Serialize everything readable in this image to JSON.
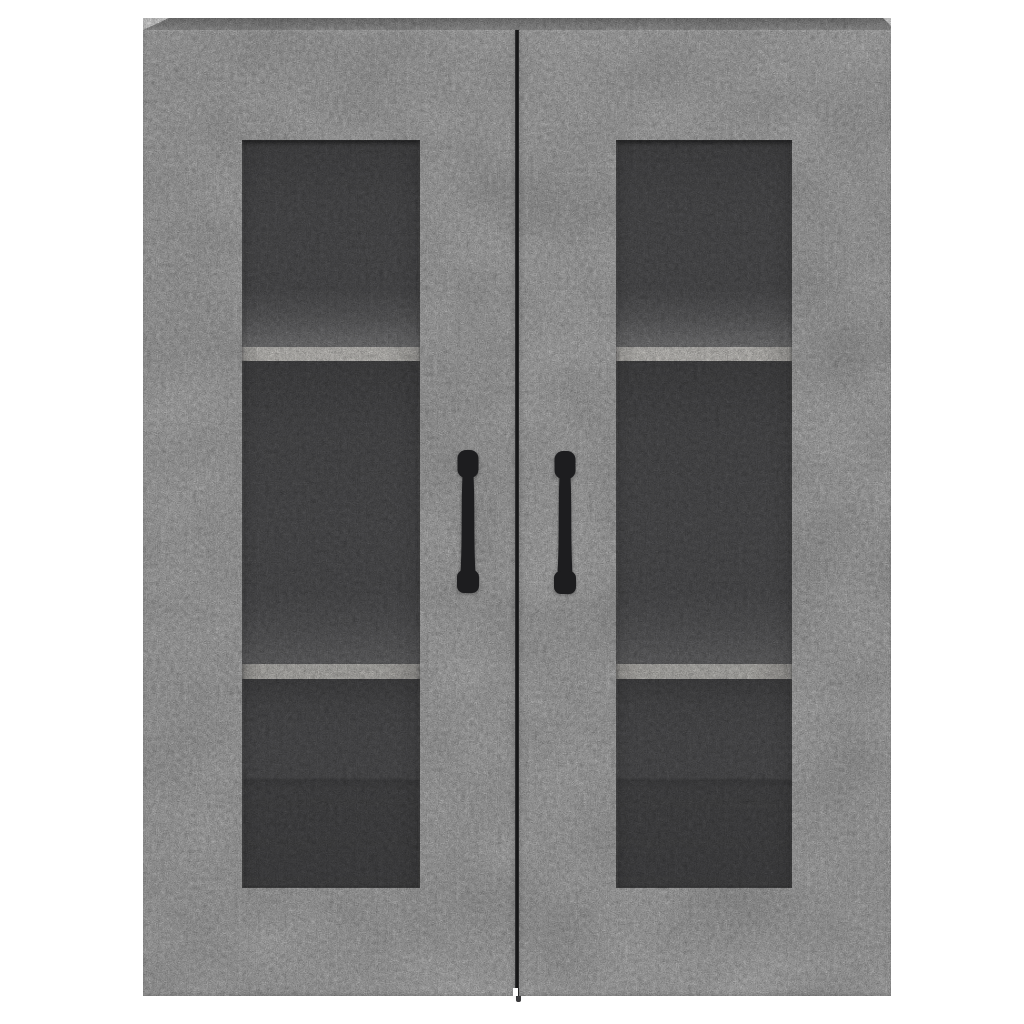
{
  "photo": {
    "subject": "wall-mounted cabinet with two glass-panel doors",
    "finish": "concrete grey",
    "background": "plain white"
  },
  "colors": {
    "background": "#ffffff",
    "concrete_base": "#c9c9c9",
    "top_face": "#aeaeae",
    "door_gap": "#232325",
    "glass_back": "#59595b",
    "glass_floor_light": "#828284",
    "shelf_edge": "#d8d6d2",
    "shelf_edge_lower": "#d0ceca",
    "under_shelf_shadow": "#4c4c4e",
    "seam_dark": "#4a4a4c",
    "handle": "#1d1d1f",
    "gap_stub": "#3a3a3c"
  },
  "structure": {
    "doors": 2,
    "handles": 2,
    "glass_panels": 2,
    "shelves_per_door": 2,
    "compartments_per_door": 3
  },
  "geometry": {
    "cabinet": {
      "left": 143,
      "top": 18,
      "width": 748,
      "height": 978
    },
    "top_face_height": 12,
    "door_gap_x": 515,
    "glass_left": {
      "x": 242,
      "y": 140,
      "width": 178,
      "height": 748
    },
    "glass_right": {
      "x": 616,
      "y": 140,
      "width": 176,
      "height": 748
    },
    "shelf_front_edges_y": [
      347,
      664
    ],
    "handle_left_center_x": 468,
    "handle_right_center_x": 565,
    "handle_top_y": 450,
    "handle_bottom_y": 592
  }
}
